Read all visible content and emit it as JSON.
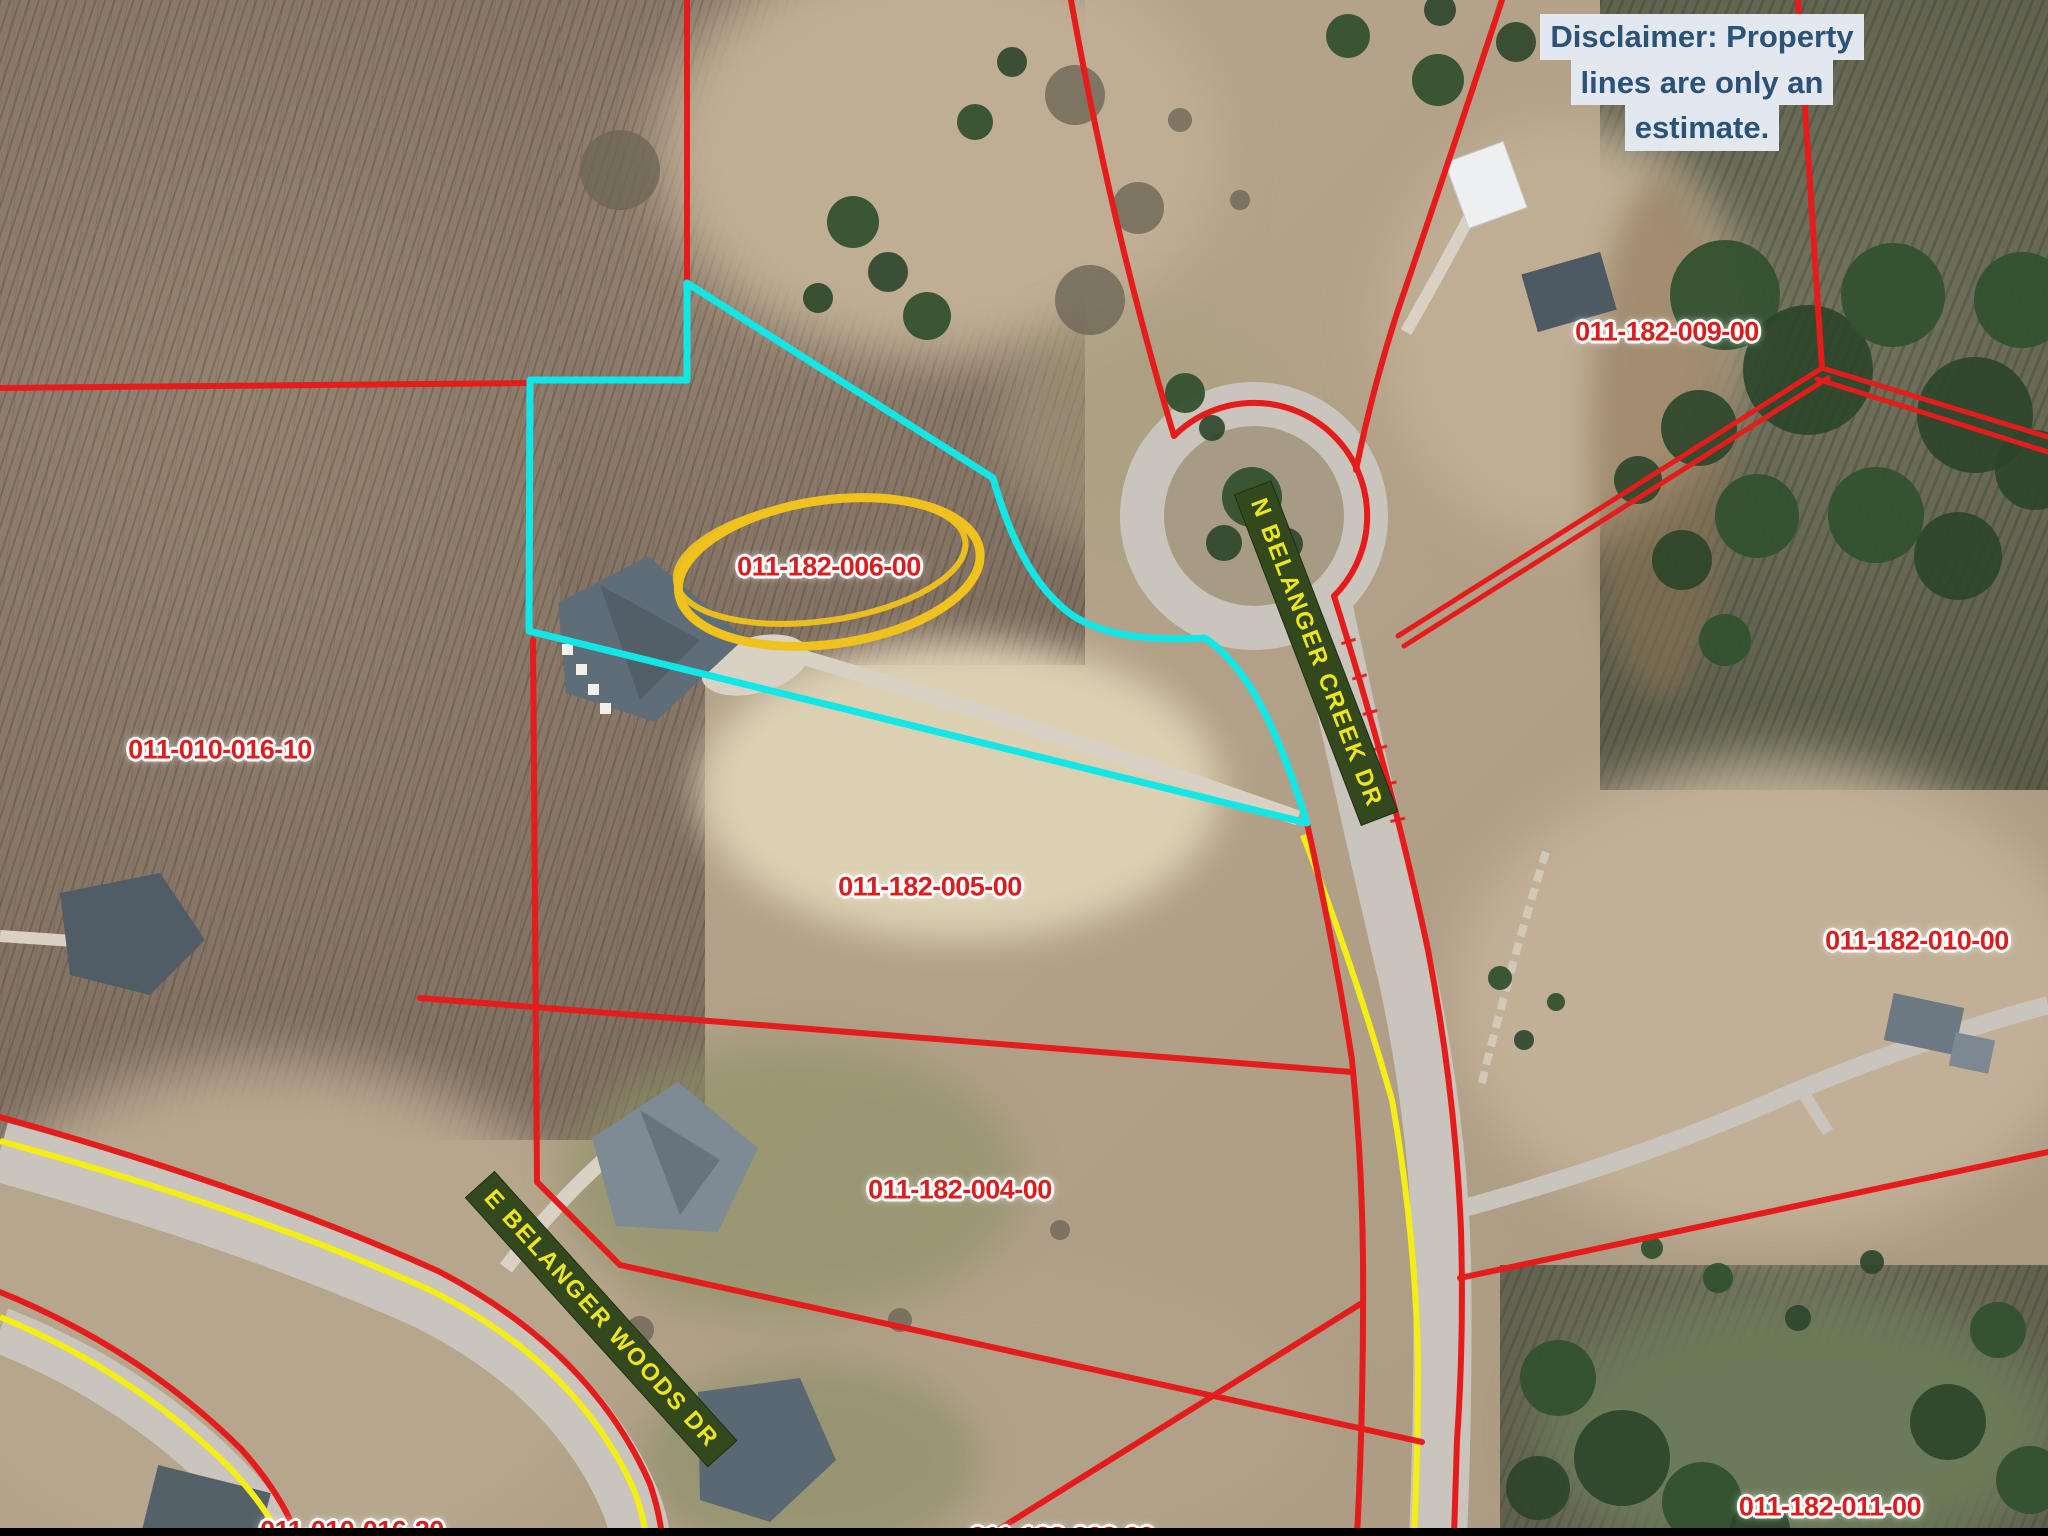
{
  "map": {
    "description": "Aerial parcel map with property line overlay"
  },
  "disclaimer": {
    "line1": "Disclaimer: Property",
    "line2": "lines are only an",
    "line3": "estimate."
  },
  "parcel_labels": {
    "p009": "011-182-009-00",
    "p006": "011-182-006-00",
    "p016_10": "011-010-016-10",
    "p005": "011-182-005-00",
    "p010": "011-182-010-00",
    "p004": "011-182-004-00",
    "p011": "011-182-011-00",
    "p016_20": "011-010-016-20",
    "p003": "011-182-003-00"
  },
  "road_labels": {
    "n_belanger_creek": "N BELANGER CREEK DR",
    "e_belanger_woods": "E BELANGER WOODS DR"
  },
  "colors": {
    "parcel_red": "#e51c1c",
    "label_red": "#d81e1e",
    "highlight_cyan": "#12e7e7",
    "road_yellow": "#f4ee15",
    "annotation_gold": "#efc21d",
    "road_label_bg": "#33491d",
    "road_label_text": "#ece51f",
    "disclaimer_bg": "#e3e7ee",
    "disclaimer_text": "#2b5277"
  }
}
